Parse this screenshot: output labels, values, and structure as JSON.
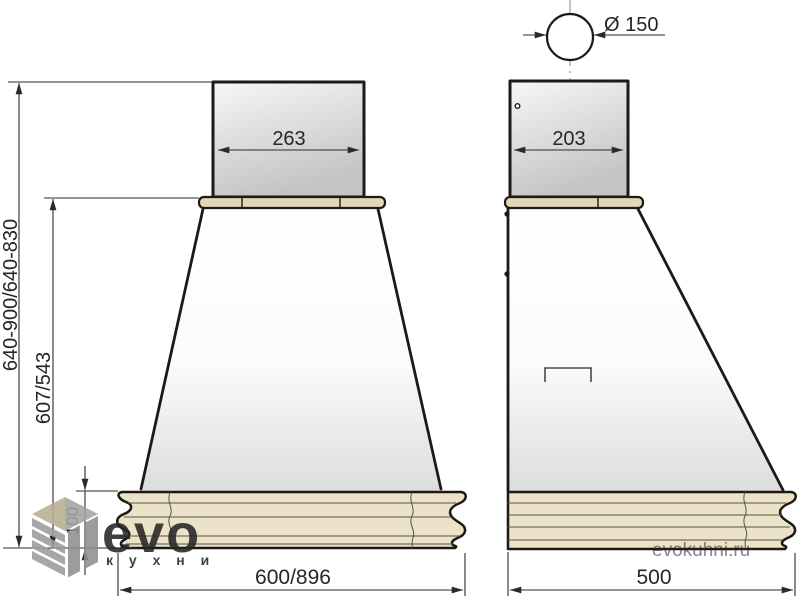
{
  "drawing": {
    "title": "cooker-hood dimensional drawing, front and side views"
  },
  "views": {
    "front": {
      "duct_width": "263",
      "base_width": "600/896",
      "total_height_range": "640-900/640-830",
      "canopy_height": "607/543",
      "base_height": "100"
    },
    "side": {
      "duct_width": "203",
      "base_width": "500",
      "flue_diameter": "Ø 150"
    }
  },
  "logo": {
    "brand": "evo",
    "subtitle": "к у х н и",
    "watermark": "evokuhni.ru"
  },
  "colors": {
    "outline": "#1d1a14",
    "dim_line": "#2a2a2a",
    "cornice_beige": "#ece2c8",
    "strip_beige": "#e3d6b6",
    "logo_gray": "#a0a0a0",
    "centerline_gray": "#9aa0a3"
  }
}
